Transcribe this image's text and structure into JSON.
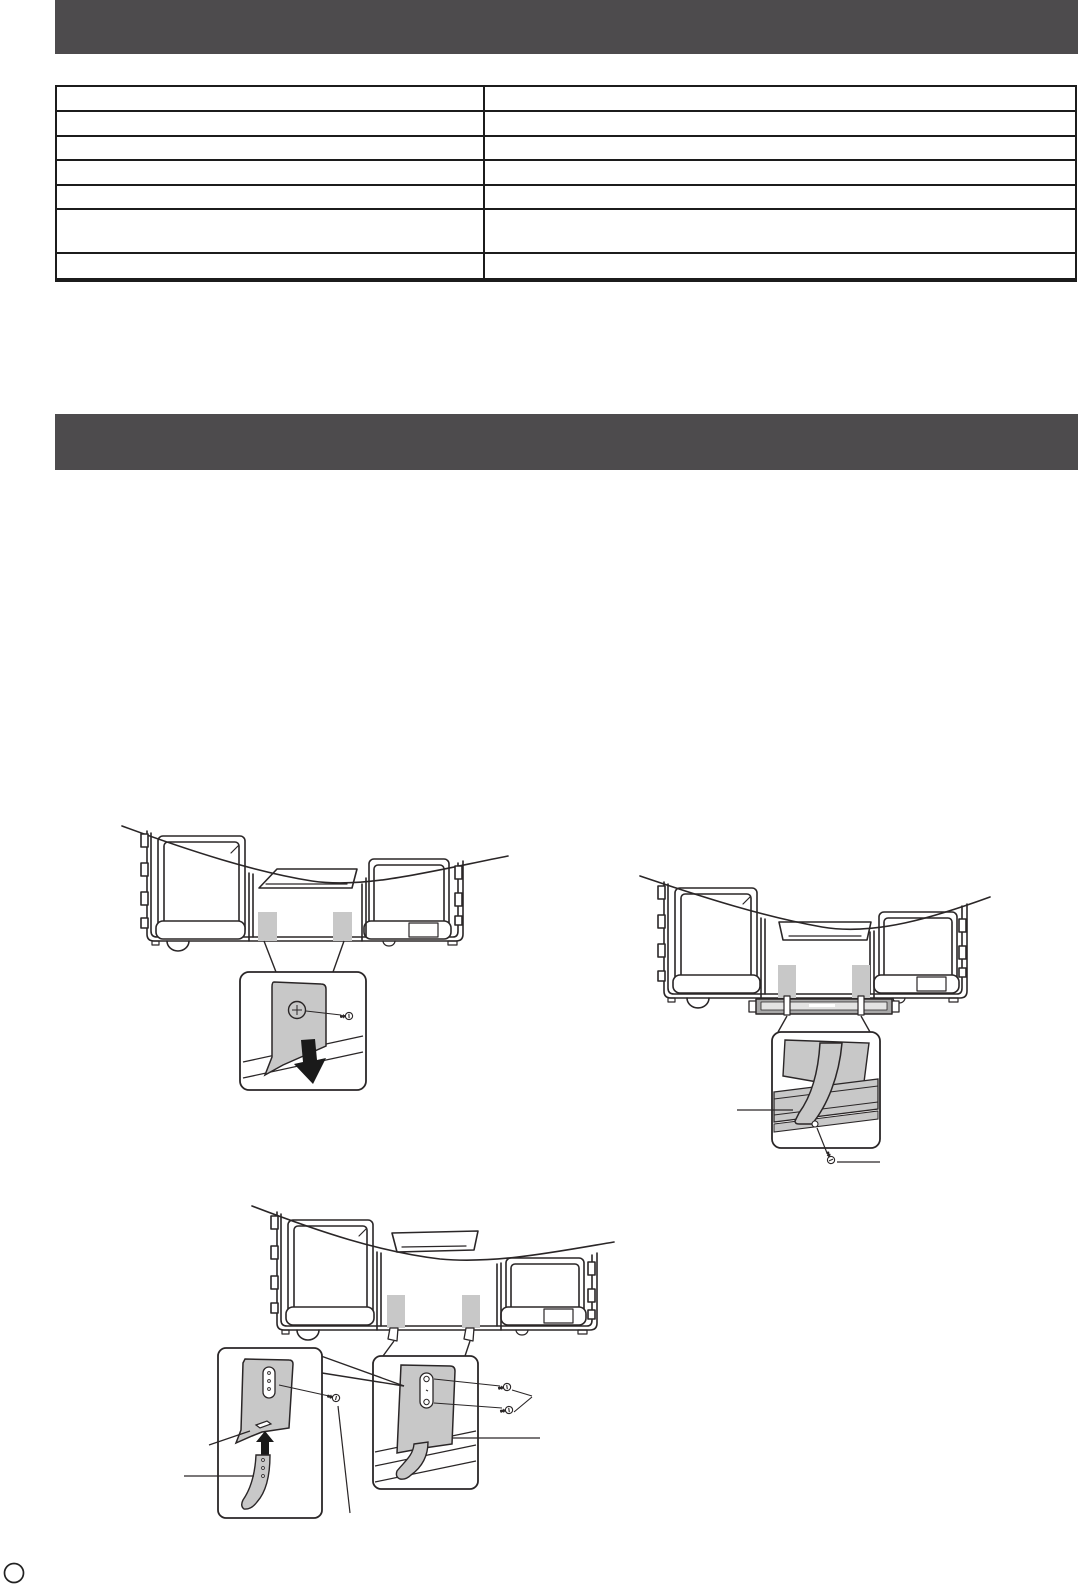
{
  "page": {
    "background": "#ffffff"
  },
  "colors": {
    "section_bar": "#4d4b4d",
    "line_art": "#2a2627",
    "fill_gray": "#c8c8c8",
    "stand_bar_gray": "#a8a8a8",
    "stand_bar_inner": "#e3e3e3",
    "arrow_black": "#1a1a1a",
    "table_border": "#1c1c1c"
  },
  "sections": [
    {
      "title": ""
    },
    {
      "title": ""
    }
  ],
  "table": {
    "rows": 7,
    "columns": 2,
    "cells": [
      [
        "",
        ""
      ],
      [
        "",
        ""
      ],
      [
        "",
        ""
      ],
      [
        "",
        ""
      ],
      [
        "",
        ""
      ],
      [
        "",
        ""
      ],
      [
        "",
        ""
      ]
    ]
  },
  "diagrams": [
    {
      "id": "strap-screw-step",
      "label": ""
    },
    {
      "id": "strap-table-fix-step",
      "label": ""
    },
    {
      "id": "bracket-assembly-step",
      "label": ""
    }
  ],
  "page_marker": {
    "label": ""
  }
}
